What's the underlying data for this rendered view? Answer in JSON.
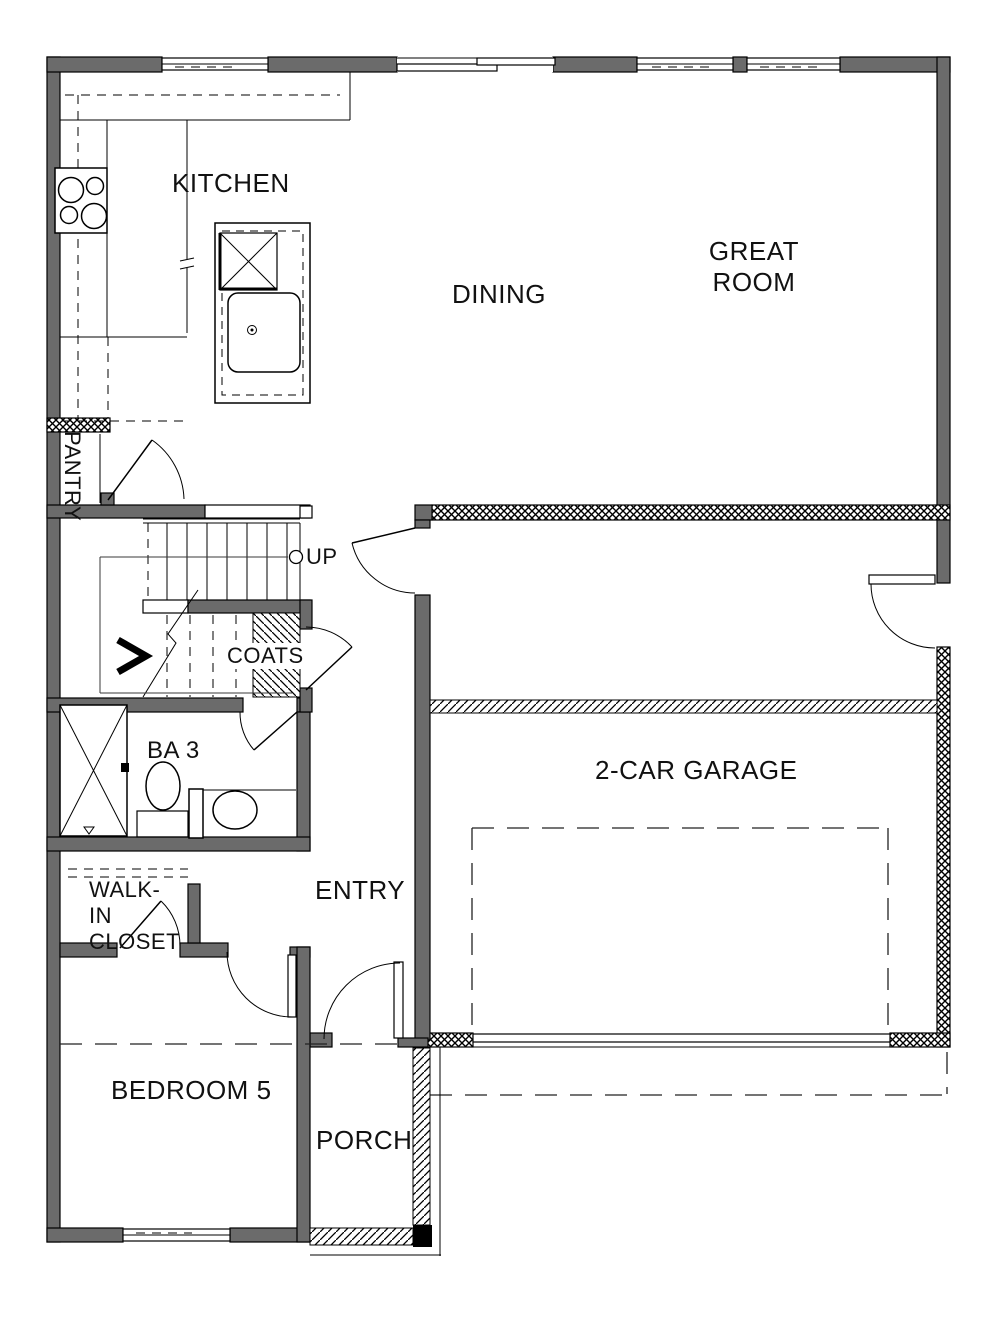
{
  "floorplan": {
    "title": "First floor plan",
    "labels": {
      "kitchen": "KITCHEN",
      "dining": "DINING",
      "great_room": "GREAT ROOM",
      "pantry": "PANTRY",
      "up": "UP",
      "coats": "COATS",
      "bath3": "BA 3",
      "walk_in_closet": "WALK-IN CLOSET",
      "entry": "ENTRY",
      "garage": "2-CAR GARAGE",
      "bedroom5": "BEDROOM 5",
      "porch": "PORCH"
    },
    "colors": {
      "wall_fill": "#6b6b6b",
      "line": "#000000",
      "text": "#111111",
      "background": "#ffffff"
    }
  }
}
